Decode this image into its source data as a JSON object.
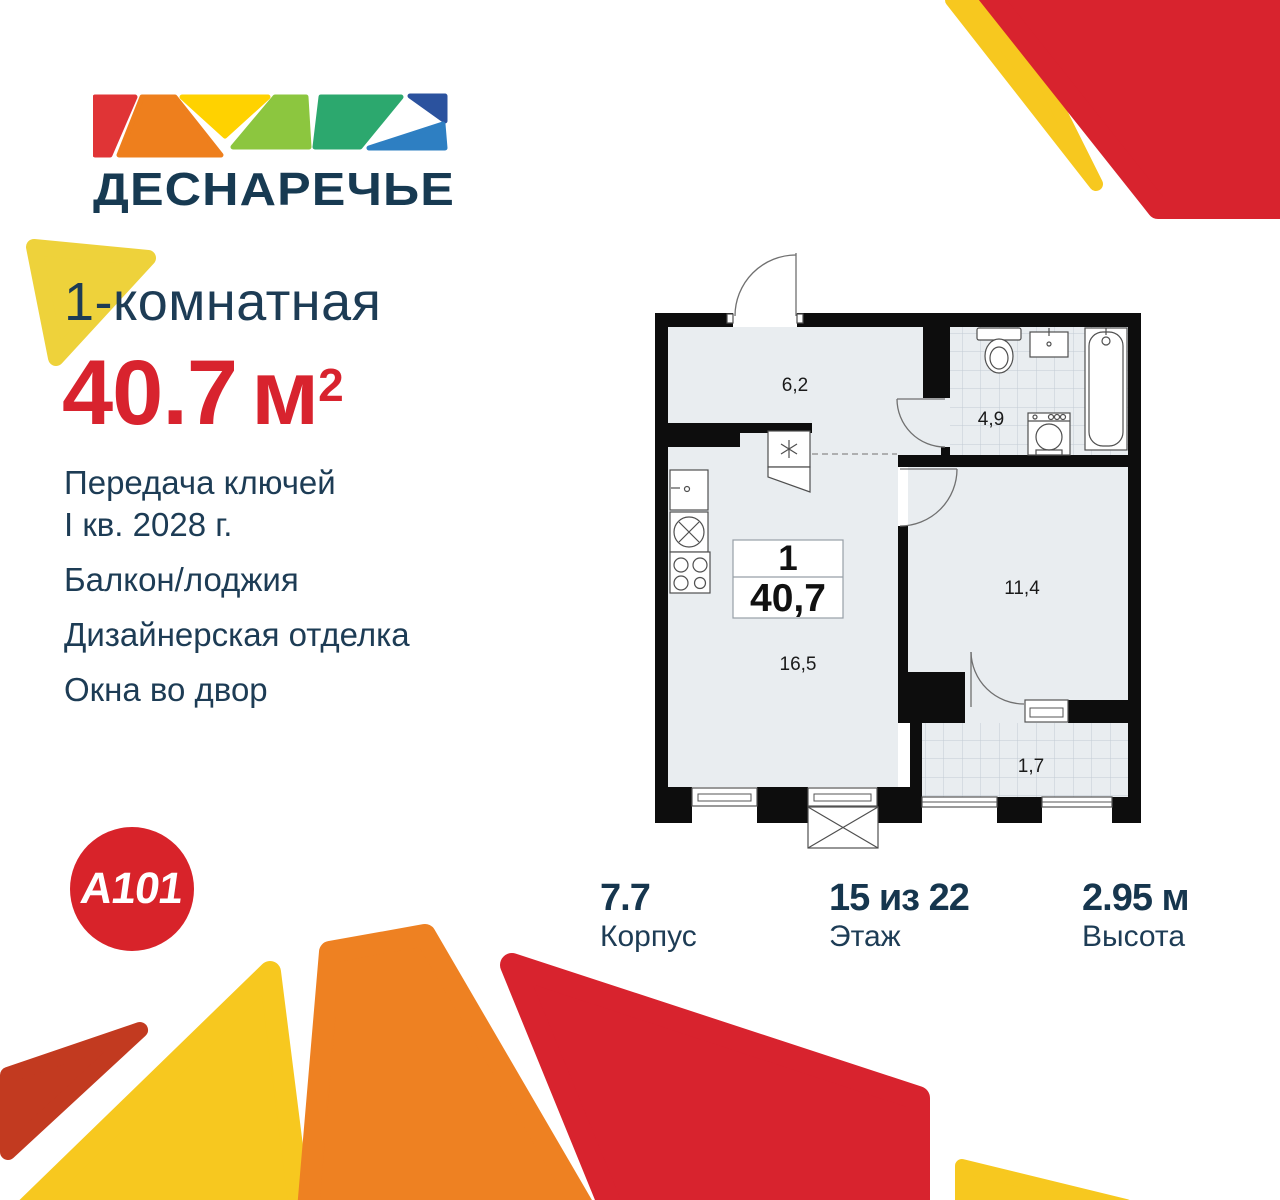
{
  "brand": {
    "name": "ДЕСНАРЕЧЬЕ",
    "developer": "A101"
  },
  "listing": {
    "rooms_title": "1-комнатная",
    "area": "40.7",
    "area_unit": "м",
    "area_superscript": "2",
    "features": [
      {
        "lines": [
          "Передача ключей",
          "I кв. 2028 г."
        ]
      },
      {
        "lines": [
          "Балкон/лоджия"
        ]
      },
      {
        "lines": [
          "Дизайнерская отделка"
        ]
      },
      {
        "lines": [
          "Окна во двор"
        ]
      }
    ]
  },
  "floor_plan": {
    "summary_rooms": "1",
    "summary_area": "40,7",
    "labels": {
      "hallway": "6,2",
      "bathroom": "4,9",
      "bedroom": "11,4",
      "kitchen_living": "16,5",
      "balcony": "1,7"
    }
  },
  "details": [
    {
      "value": "7.7",
      "label": "Корпус"
    },
    {
      "value": "15 из 22",
      "label": "Этаж"
    },
    {
      "value": "2.95 м",
      "label": "Высота"
    }
  ],
  "colors": {
    "navy": "#1d3c55",
    "accent_red": "#d8232e",
    "yellow": "#f7c81f",
    "orange": "#ee8122",
    "brick_red": "#c23a20"
  }
}
